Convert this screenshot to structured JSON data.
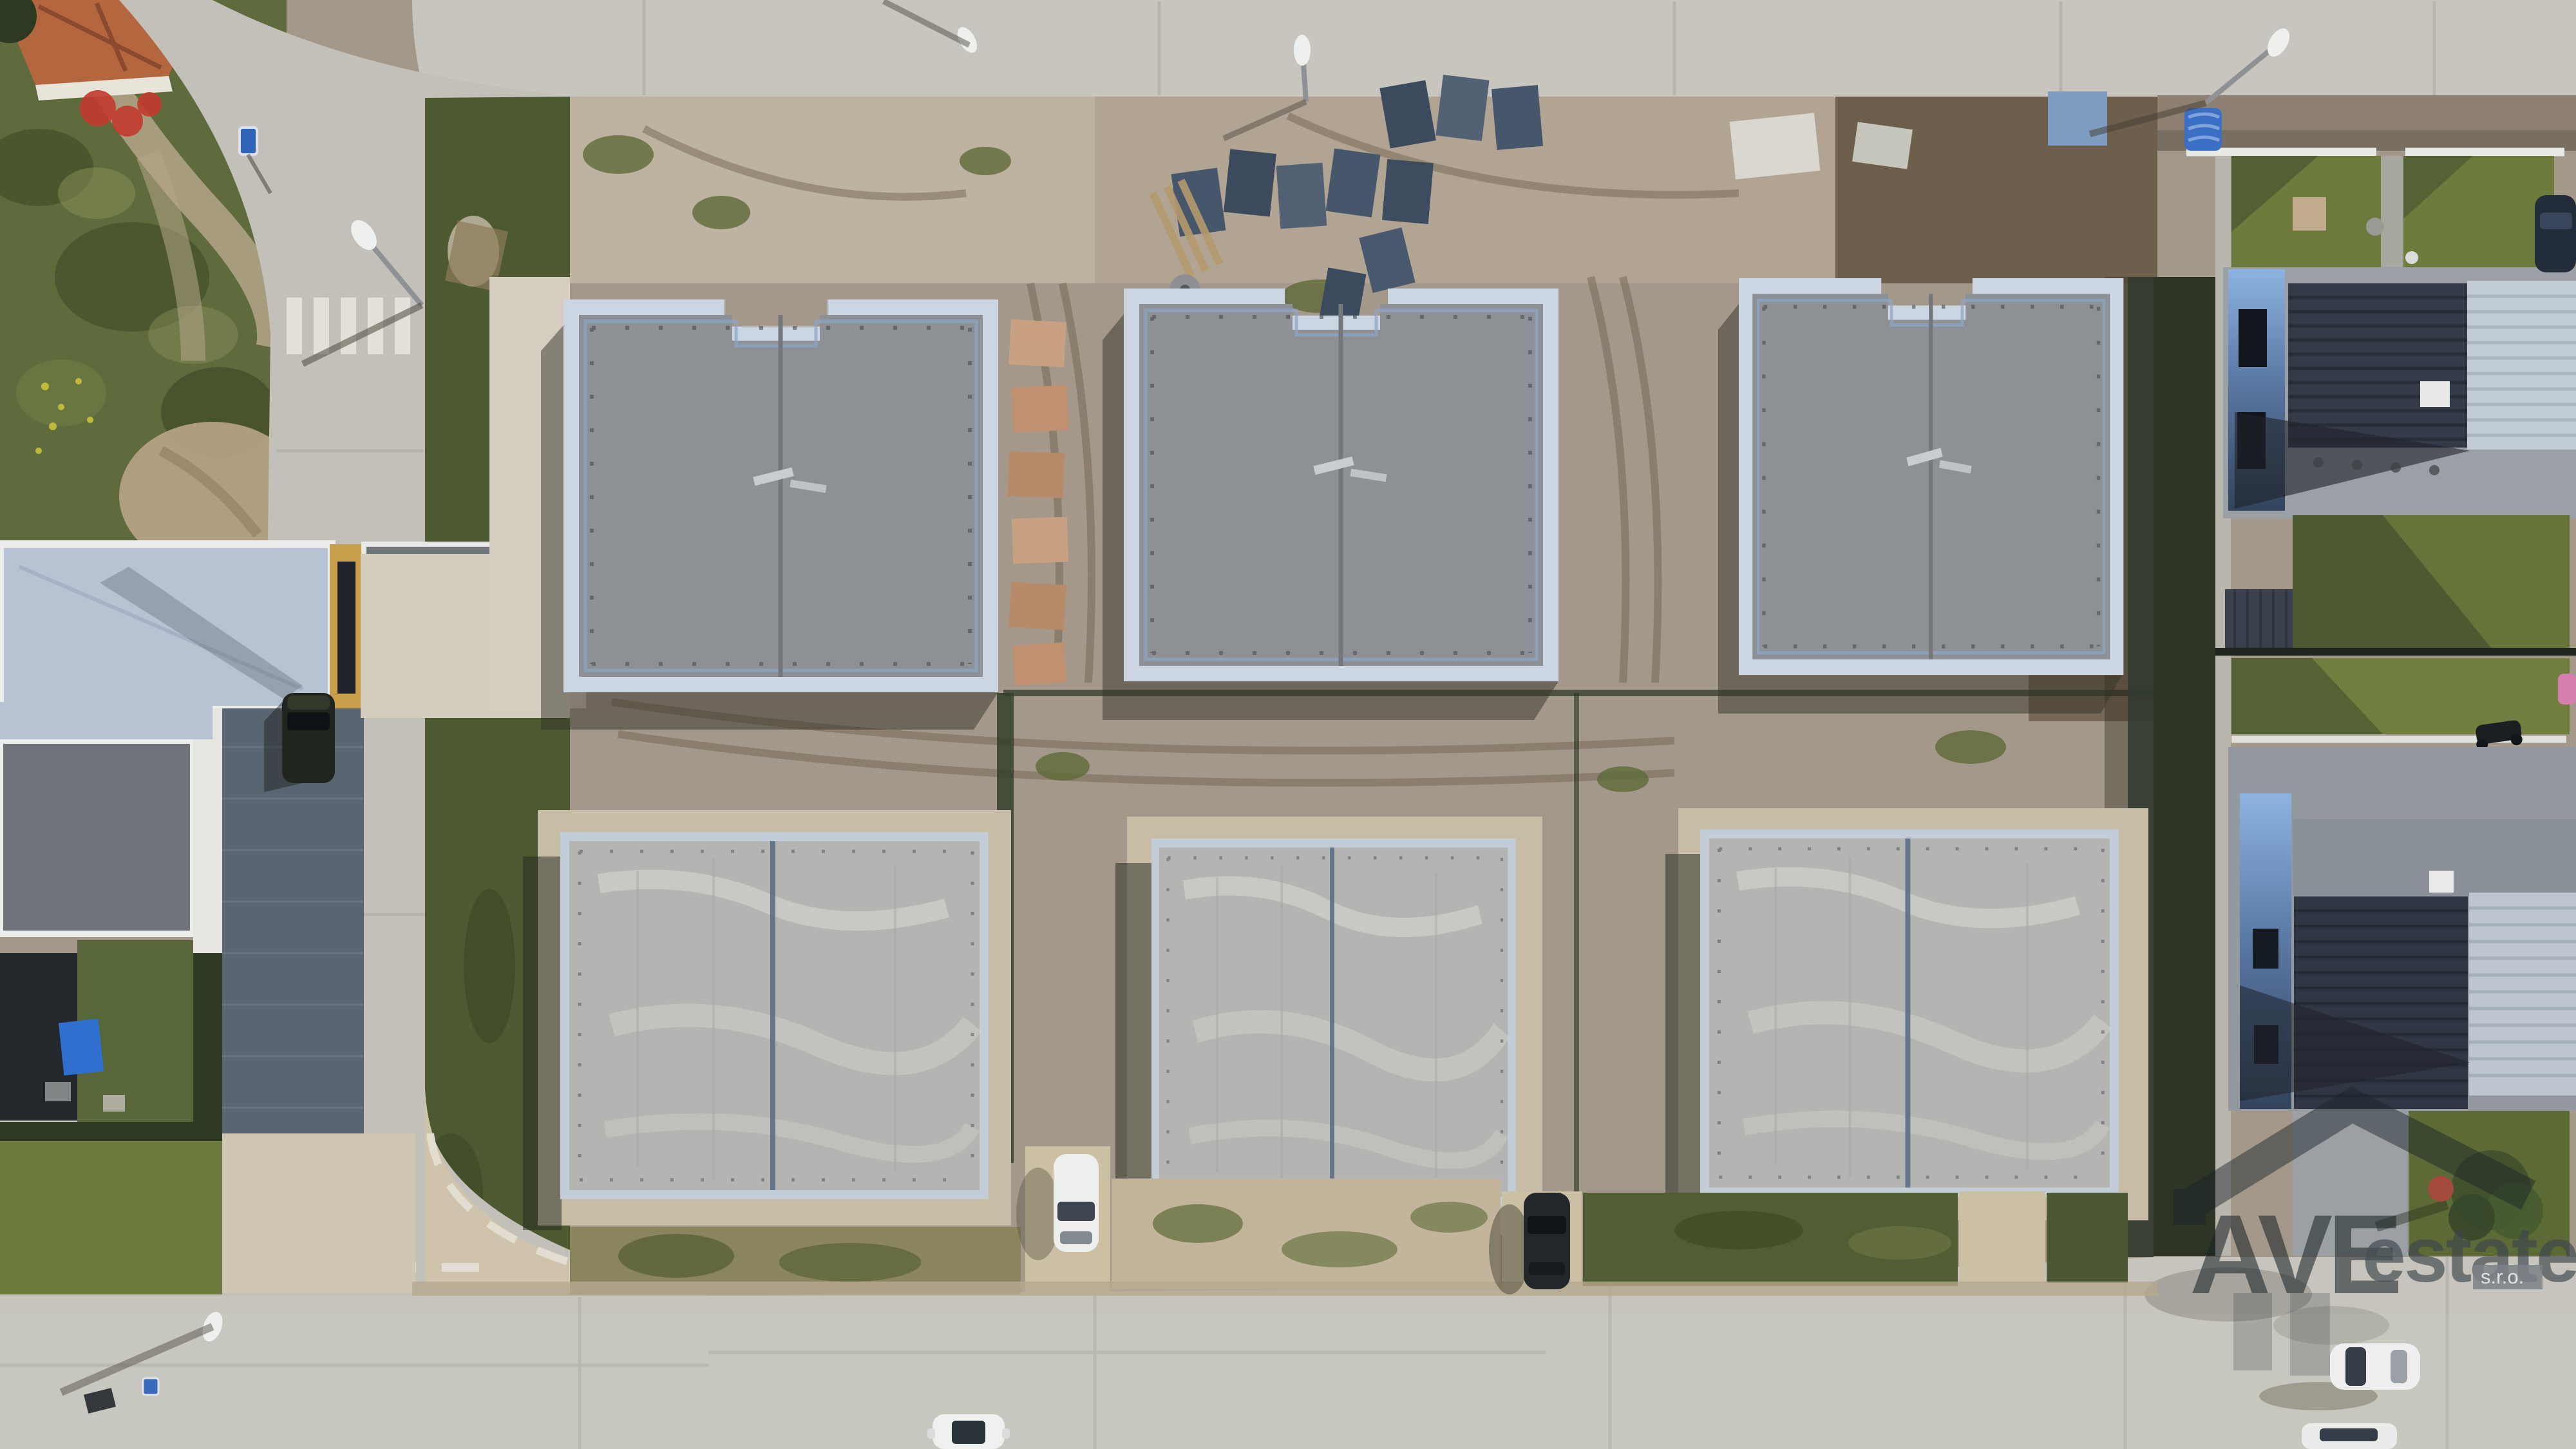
{
  "image": {
    "kind": "aerial-drone-photo",
    "subject": "top-down view of a suburban block with six duplex houses under construction between finished residential streets"
  },
  "watermark": {
    "brand_prefix": "AVE",
    "brand_suffix": "estate",
    "legal": "s.r.o."
  },
  "scene": {
    "construction": {
      "houses_under_construction": 6,
      "rows": 2,
      "houses_per_row": 3,
      "row1_roof": "dark grey flat roof with pale parapet edging",
      "row2_roof": "light grey concrete deck with pale mottling"
    },
    "street_furniture": {
      "street_lamps": 5,
      "blue_road_signs": 2,
      "zebra_crossings": 1,
      "material_pallets": 11
    },
    "vehicles": [
      {
        "type": "car",
        "color": "dark green",
        "location": "left parking pad"
      },
      {
        "type": "car",
        "color": "white",
        "location": "centre driveway"
      },
      {
        "type": "car",
        "color": "black",
        "location": "centre-right driveway"
      },
      {
        "type": "car",
        "color": "white",
        "location": "bottom road, partially cropped"
      },
      {
        "type": "car",
        "color": "white",
        "location": "bottom-right road"
      },
      {
        "type": "car",
        "color": "white",
        "location": "bottom-right edge, partially cropped"
      },
      {
        "type": "car",
        "color": "dark blue",
        "location": "top-right driveway, partially cropped"
      },
      {
        "type": "car",
        "color": "pink",
        "location": "right edge, partially cropped"
      }
    ],
    "colors": {
      "road": "#c7c5be",
      "road_left": "#c2c0b9",
      "road_bottom": "#c6c4bc",
      "dirt": "#a4988a",
      "dirt_dark": "#6e5f4d",
      "gravel_white": "#d3cbbb",
      "scrub_green": "#5f6b3c",
      "lawn_green": "#6d7b3c",
      "roof_row1": "#8d9196",
      "parapet_row1": "#ccd6e2",
      "roof_row2": "#b4b5b3",
      "apron_beige": "#c7bda6",
      "roof_dark_slate": "#333b49",
      "roof_light_metal": "#c3cdd6",
      "estate_roof_blue": "#b7c3d2",
      "watermark_dark": "#1c2528",
      "watermark_gray": "#3e474d"
    }
  }
}
